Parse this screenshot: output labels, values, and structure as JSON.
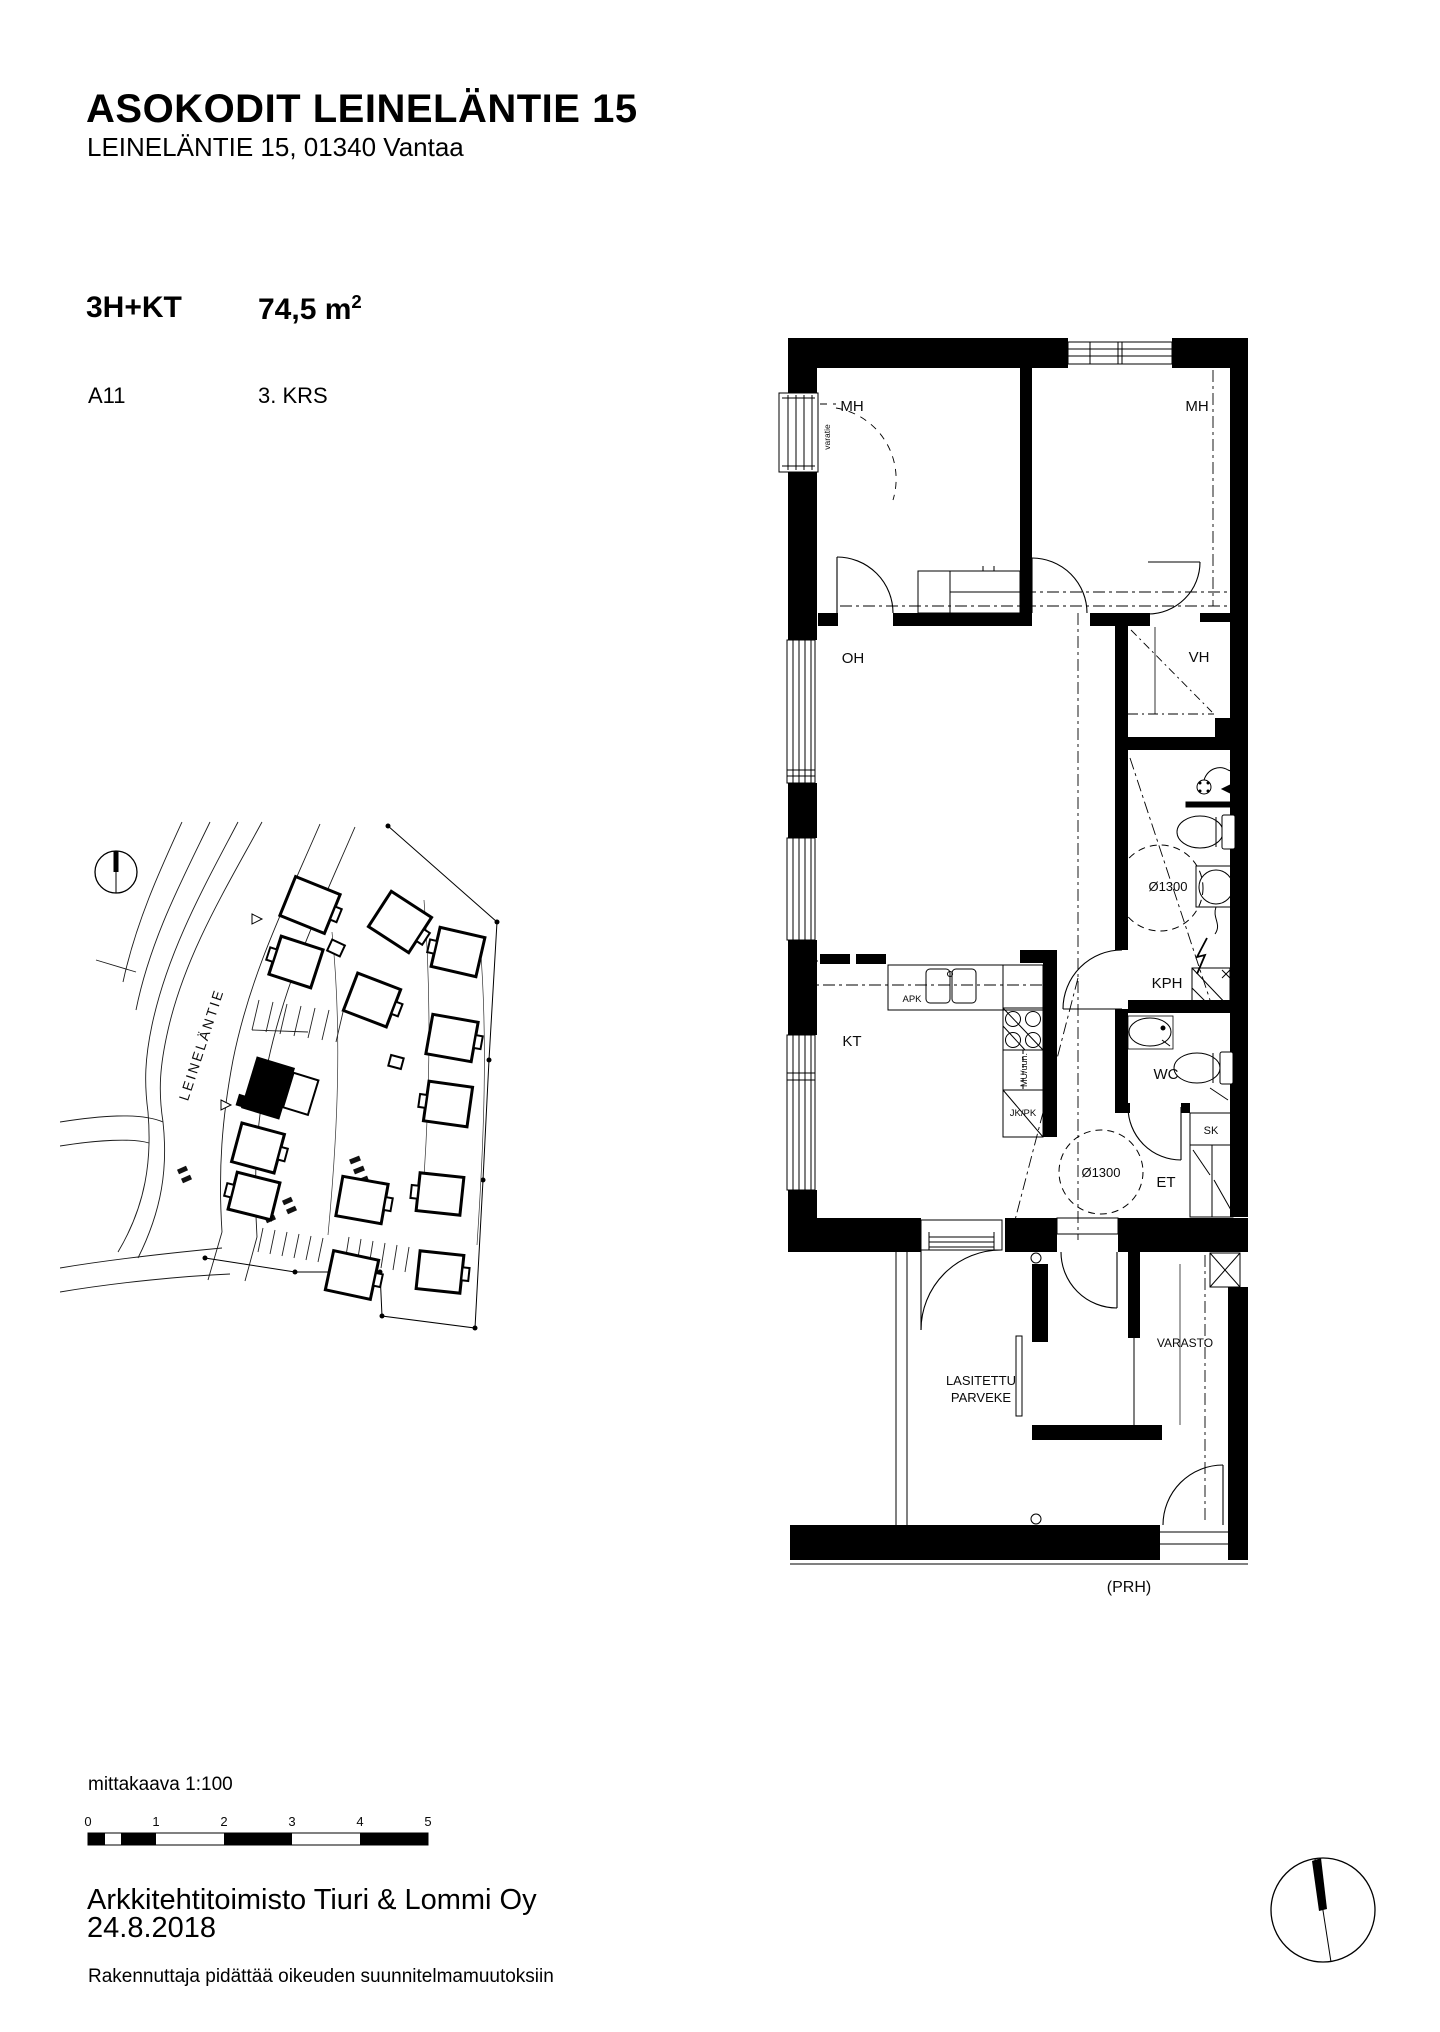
{
  "header": {
    "title": "ASOKODIT LEINELÄNTIE 15",
    "subtitle": "LEINELÄNTIE 15, 01340 Vantaa"
  },
  "apartment": {
    "type": "3H+KT",
    "area": "74,5 m",
    "area_sup": "2",
    "unit": "A11",
    "floor": "3. KRS"
  },
  "floor_plan": {
    "rooms": {
      "mh_left": "MH",
      "mh_right": "MH",
      "oh": "OH",
      "vh": "VH",
      "kph": "KPH",
      "wc": "WC",
      "kt": "KT",
      "et": "ET",
      "sk": "SK",
      "varasto": "VARASTO",
      "balcony_line1": "LASITETTU",
      "balcony_line2": "PARVEKE",
      "stairwell": "(PRH)"
    },
    "annotations": {
      "varatie": "varatie",
      "kph_circle": "Ø1300",
      "et_circle": "Ø1300",
      "apk": "APK",
      "mu": "MU/uun.",
      "jkpk": "JK/PK"
    }
  },
  "site_plan": {
    "street": "LEINELÄNTIE"
  },
  "footer": {
    "scale_label": "mittakaava 1:100",
    "scale_ticks": [
      "0",
      "1",
      "2",
      "3",
      "4",
      "5"
    ],
    "company": "Arkkitehtitoimisto Tiuri & Lommi Oy",
    "date": "24.8.2018",
    "disclaimer": "Rakennuttaja pidättää oikeuden suunnitelmamuutoksiin"
  }
}
